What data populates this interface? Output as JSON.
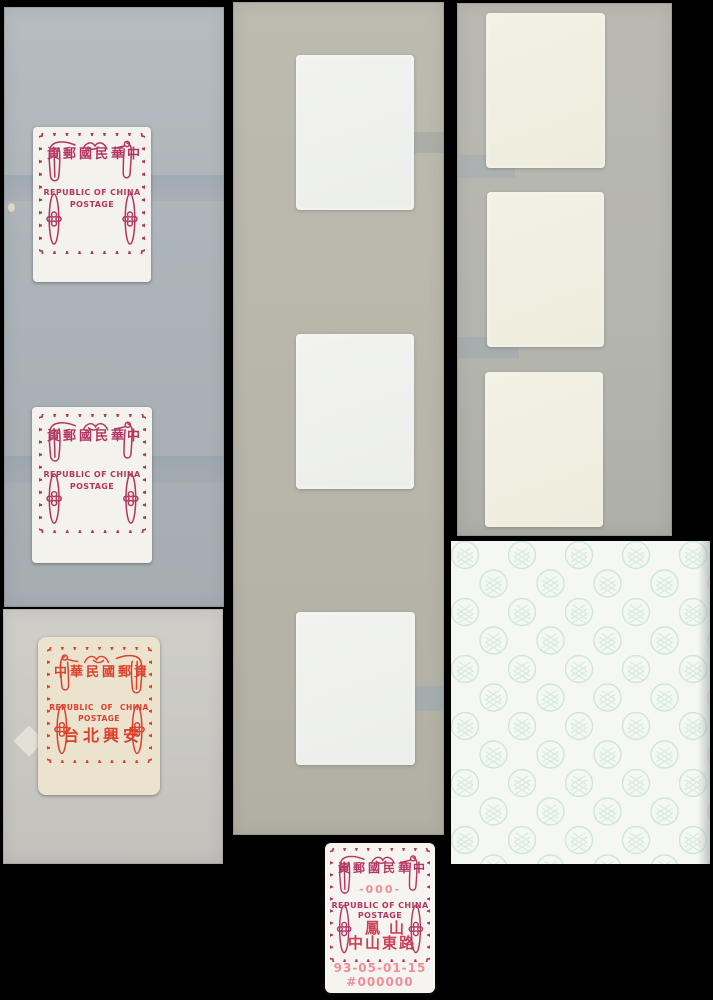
{
  "photo": {
    "background_color": "#000000",
    "mount_cards": 4,
    "blank_white_labels": 3,
    "blank_cream_labels": 3
  },
  "colors": {
    "crimson_frame": "#b43562",
    "orange_red_frame": "#dd3f2b",
    "machine_print_pink": "#ee8e97",
    "machine_print_red": "#cb4257",
    "teal_pattern": "#c6e3d9",
    "card_blue_gray": "#adb4b9",
    "card_light_gray": "#c8c7c2",
    "card_green_gray": "#b7b6a9"
  },
  "stamps": {
    "top_stamp_1": {
      "chinese_line": "資郵國民華中",
      "english_line_1": "REPUBLIC OF CHINA",
      "english_line_2": "POSTAGE"
    },
    "top_stamp_2": {
      "chinese_line": "資郵國民華中",
      "english_line_1": "REPUBLIC OF CHINA",
      "english_line_2": "POSTAGE"
    },
    "orange_stamp": {
      "chinese_line": "中華民國郵資",
      "english_line_1": "REPUBLIC OF CHINA",
      "english_line_2": "POSTAGE",
      "office_line": "台北興安"
    },
    "machine_stamp": {
      "chinese_line": "資郵國民華中",
      "value_line": "-000-",
      "english_line_1": "REPUBLIC OF CHINA",
      "english_line_2": "POSTAGE",
      "office_line_1": "鳳山",
      "office_line_2": "中山東路",
      "date_line": "93-05-01-15",
      "serial_line": "#000000"
    }
  }
}
